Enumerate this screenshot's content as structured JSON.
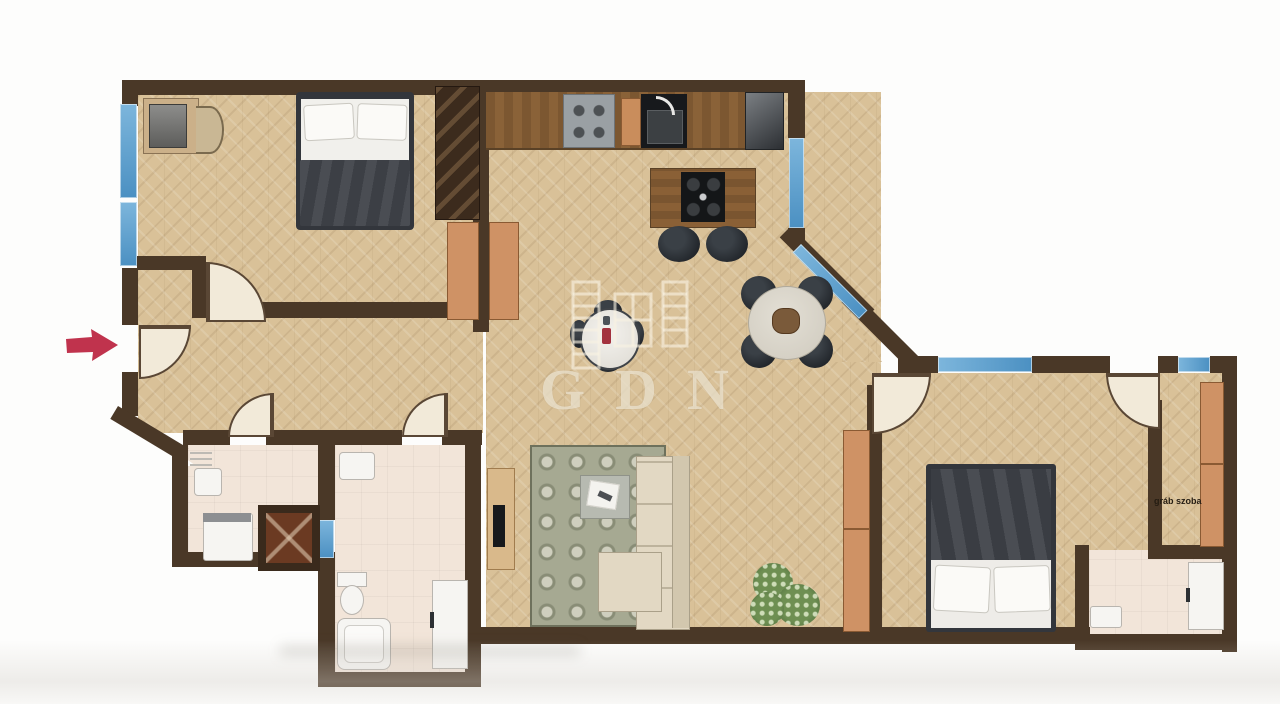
{
  "floorplan": {
    "watermark": {
      "text": "GDN",
      "logo": "gdn-building-logo"
    },
    "labels": {
      "wardrobe_room": "gráb szoba"
    },
    "entrance_marker": "red-arrow",
    "colors": {
      "wall": "#4a3827",
      "wood_floor": "#d9c198",
      "tile_floor": "#f2e5d9",
      "window_blue": "#4f97c8",
      "arrow_red": "#c0334d",
      "watermark": "#efe6d2",
      "cabinet_tan": "#cf9265"
    }
  }
}
